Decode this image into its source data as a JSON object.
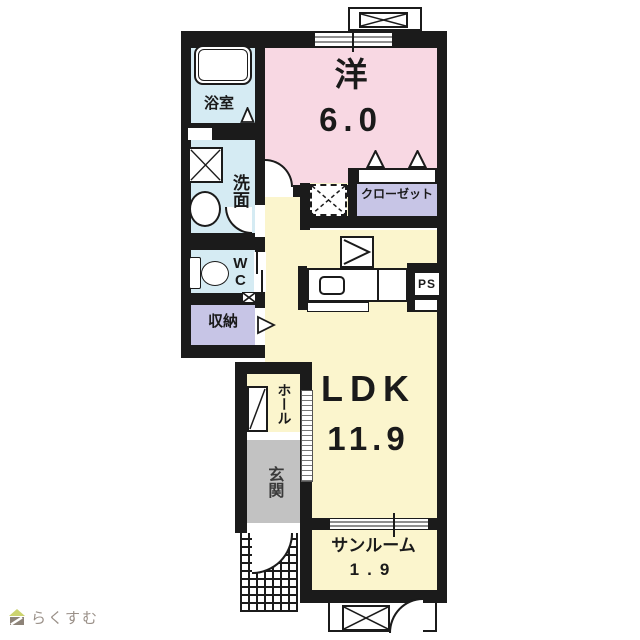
{
  "floorplan": {
    "rooms": {
      "bath": {
        "label": "浴室"
      },
      "washroom": {
        "label": "洗面"
      },
      "wc": {
        "label": "WC"
      },
      "storage": {
        "label": "収納"
      },
      "western": {
        "label": "洋",
        "size": "6.0"
      },
      "closet": {
        "label": "クローゼット"
      },
      "ldk": {
        "label": "LDK",
        "size": "11.9"
      },
      "hall": {
        "label": "ホール"
      },
      "entrance": {
        "label": "玄関"
      },
      "sunroom": {
        "label": "サンルーム",
        "size": "1.9"
      },
      "pipe_space": {
        "label": "PS"
      }
    },
    "colors": {
      "wall": "#1b1b1b",
      "wet_area": "#d5ebf3",
      "bedroom": "#f8d8e3",
      "ldk": "#fbf5cd",
      "closet": "#c7c5e6",
      "entrance": "#c2c2c2"
    }
  },
  "logo": {
    "text": "らくすむ"
  }
}
